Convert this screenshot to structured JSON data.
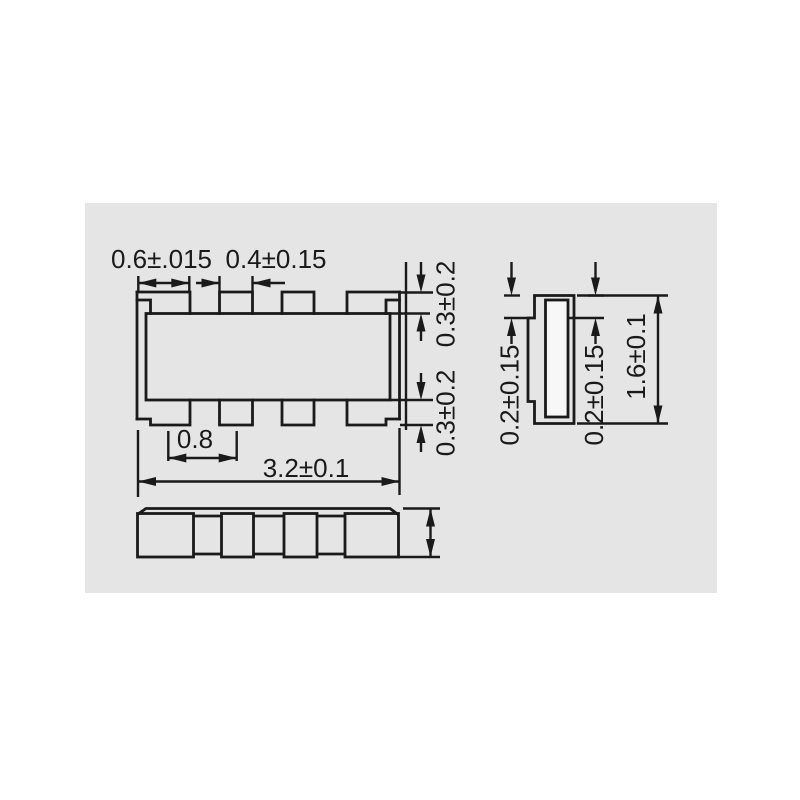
{
  "page": {
    "background": "#ffffff",
    "panel_background": "#e5e5e5",
    "line_color": "#1a1a1a"
  },
  "dimensions": {
    "top_view": {
      "end_terminal_width": "0.6±.015",
      "inner_terminal_width": "0.4±0.15",
      "terminal_pitch": "0.8",
      "body_length": "3.2±0.1",
      "terminal_protrusion_top": "0.3±0.2",
      "terminal_protrusion_bottom": "0.3±0.2"
    },
    "end_view": {
      "terminal_thickness_left": "0.2±0.15",
      "terminal_thickness_right": "0.2±0.15",
      "body_width": "1.6±0.1"
    }
  }
}
